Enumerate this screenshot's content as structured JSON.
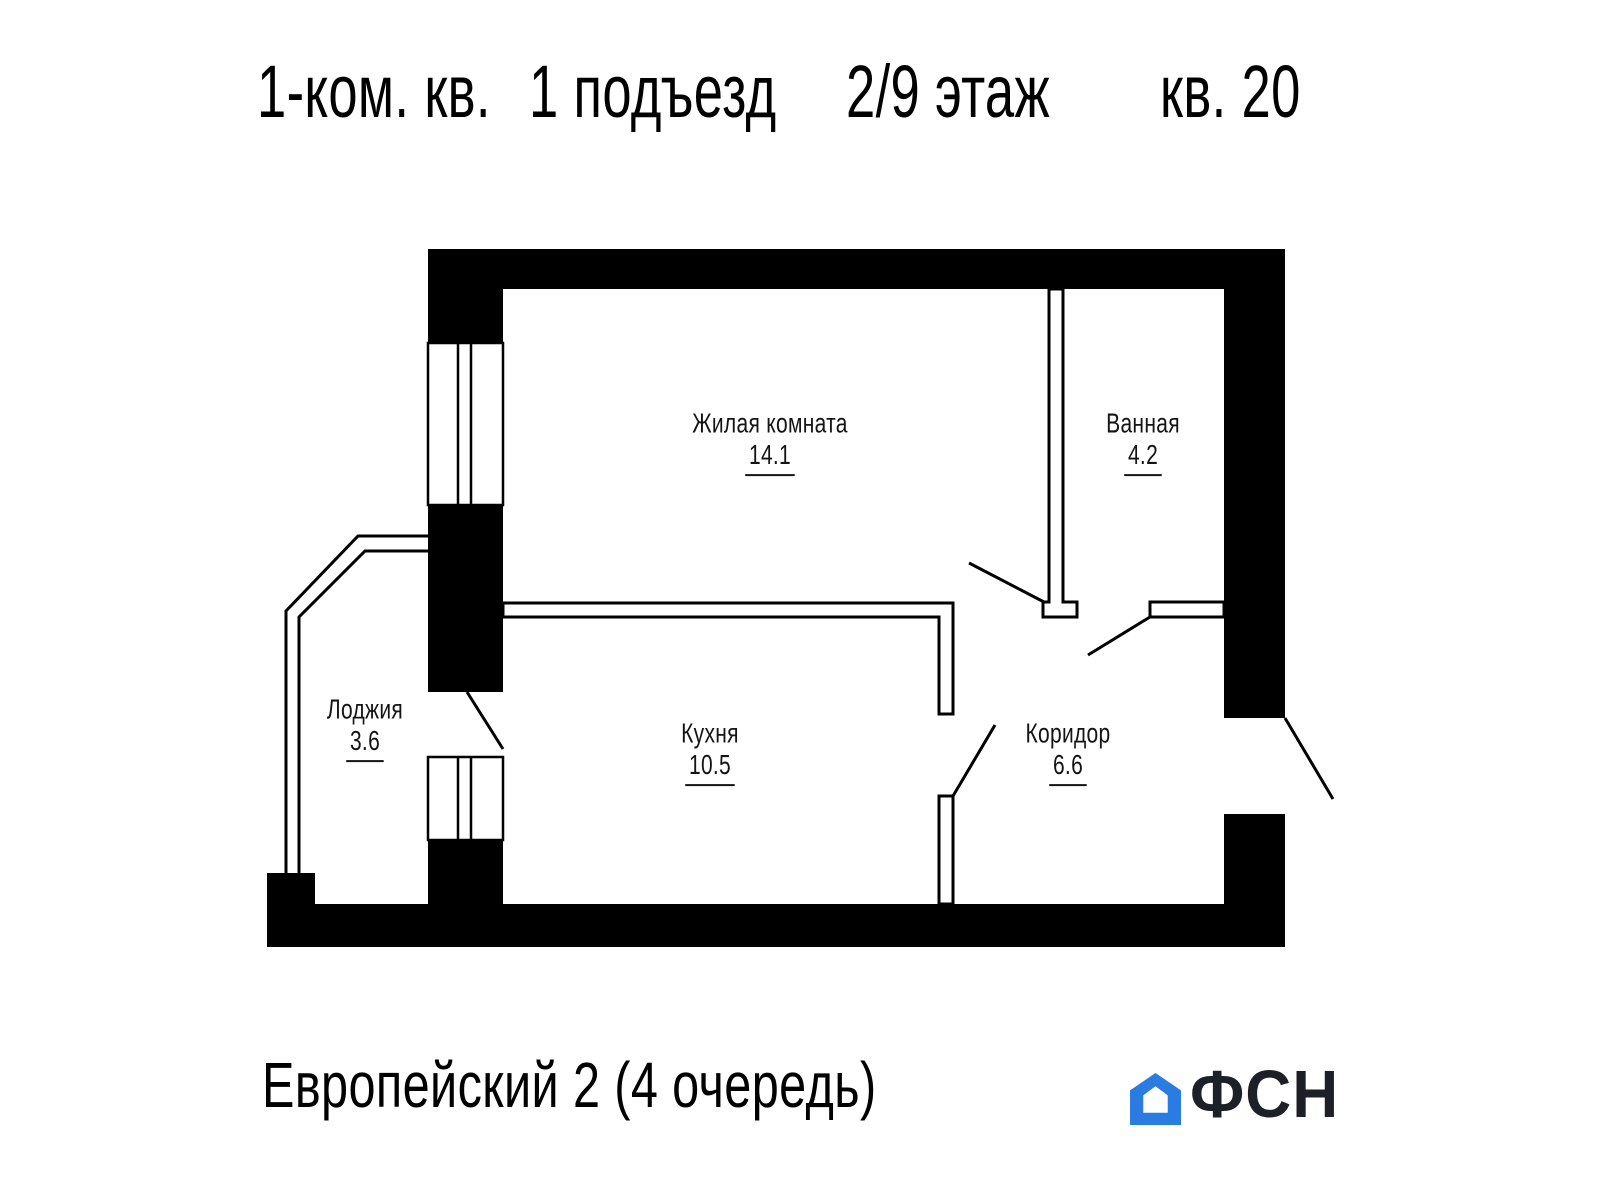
{
  "title": {
    "segments": [
      "1-ком. кв.",
      "1 подъезд",
      "2/9 этаж",
      "кв. 20"
    ]
  },
  "rooms": [
    {
      "name": "Жилая комната",
      "area": "14.1"
    },
    {
      "name": "Ванная",
      "area": "4.2"
    },
    {
      "name": "Лоджия",
      "area": "3.6"
    },
    {
      "name": "Кухня",
      "area": "10.5"
    },
    {
      "name": "Коридор",
      "area": "6.6"
    }
  ],
  "footer": {
    "project": "Европейский 2 (4 очередь)",
    "logo_text": "ФСН"
  },
  "colors": {
    "background": "#ffffff",
    "walls": "#000000",
    "lines": "#000000",
    "text": "#141414",
    "logo_blue": "#2b7ce2",
    "logo_dark": "#1d2127"
  }
}
